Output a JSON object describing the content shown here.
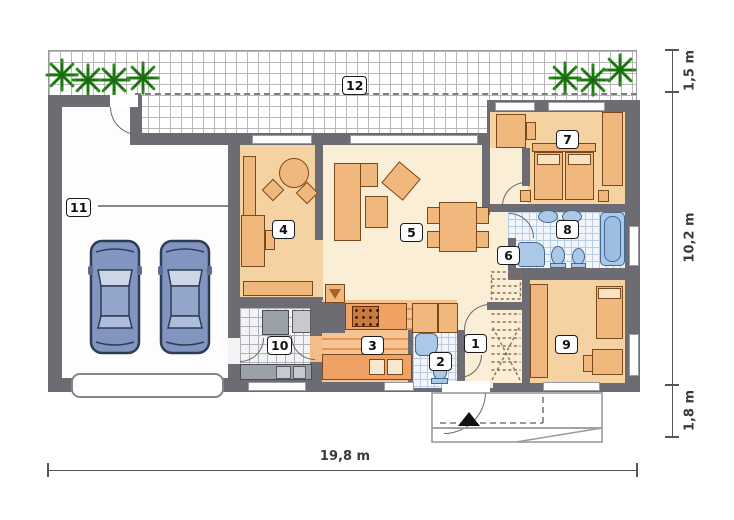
{
  "rooms": {
    "r1": "1",
    "r2": "2",
    "r3": "3",
    "r4": "4",
    "r5": "5",
    "r6": "6",
    "r7": "7",
    "r8": "8",
    "r9": "9",
    "r10": "10",
    "r11": "11",
    "r12": "12"
  },
  "dims": {
    "bottom": "19,8 m",
    "right_top": "1,5 m",
    "right_middle": "10,2 m",
    "right_bottom": "1,8 m"
  },
  "colors": {
    "wall": "#6c6c72",
    "cream": "#faeed6",
    "peach": "#f5d2a2",
    "furn": "#f1b87e",
    "furnb": "#7a4a1e",
    "counter": "#efa263",
    "water": "#abc8e8",
    "waterb": "#44688f",
    "car": "#8295c1",
    "plant": "#2e8a1e"
  }
}
